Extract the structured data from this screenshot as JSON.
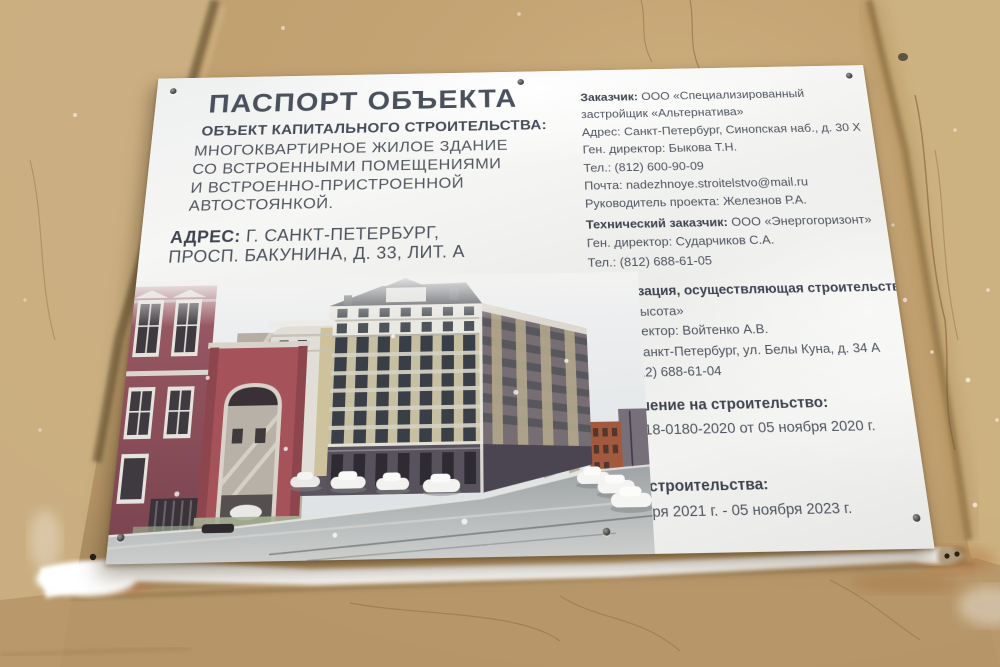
{
  "sign": {
    "title": "ПАСПОРТ ОБЪЕКТА",
    "object": {
      "heading": "ОБЪЕКТ КАПИТАЛЬНОГО СТРОИТЕЛЬСТВА:",
      "lines": [
        "МНОГОКВАРТИРНОЕ ЖИЛОЕ ЗДАНИЕ",
        "СО ВСТРОЕННЫМИ ПОМЕЩЕНИЯМИ",
        "И ВСТРОЕННО-ПРИСТРОЕННОЙ",
        "АВТОСТОЯНКОЙ."
      ]
    },
    "address": {
      "label": "АДРЕС:",
      "line1": "Г. САНКТ-ПЕТЕРБУРГ,",
      "line2": "ПРОСП. БАКУНИНА, Д. 33, ЛИТ. А"
    },
    "customer": {
      "label": "Заказчик:",
      "value": "ООО «Специализированный",
      "value2": "застройщик «Альтернатива»",
      "address": "Адрес: Санкт-Петербург, Синопская наб., д. 30 Х",
      "director": "Ген. директор: Быкова Т.Н.",
      "phone": "Тел.: (812) 600-90-09",
      "email": "Почта: nadezhnoye.stroitelstvo@mail.ru",
      "project_manager": "Руководитель проекта: Железнов Р.А."
    },
    "technical_customer": {
      "label": "Технический заказчик:",
      "value": "ООО «Энергогоризонт»",
      "director": "Ген. директор: Сударчиков С.А.",
      "phone": "Тел.: (812) 688-61-05"
    },
    "builder": {
      "heading": "Организация, осуществляющая строительство:",
      "company": "ООО «Высота»",
      "director": "Ген. директор: Войтенко А.В.",
      "address": "Адрес:Санкт-Петербург, ул. Белы Куна, д. 34 А",
      "phone": "Тел.:  (812) 688-61-04"
    },
    "permit": {
      "heading": "Разрешение на строительство:",
      "value": "№ 78-018-0180-2020 от 05 ноября 2020 г."
    },
    "timeline": {
      "heading": "Сроки строительства:",
      "value": "25 января 2021 г. - 05 ноября 2023 г."
    }
  },
  "colors": {
    "wall": "#c2a171",
    "sign": "#f0f0ee",
    "text": "#4f5560",
    "heading": "#3e4450",
    "render_sky": "#e9ebed",
    "render_facade": "#c6bfa1",
    "render_base": "#57525b",
    "render_maroon": "#94555f",
    "render_gate": "#a5525a",
    "render_orange": "#a3593e",
    "snow": "#fbfbfa"
  }
}
